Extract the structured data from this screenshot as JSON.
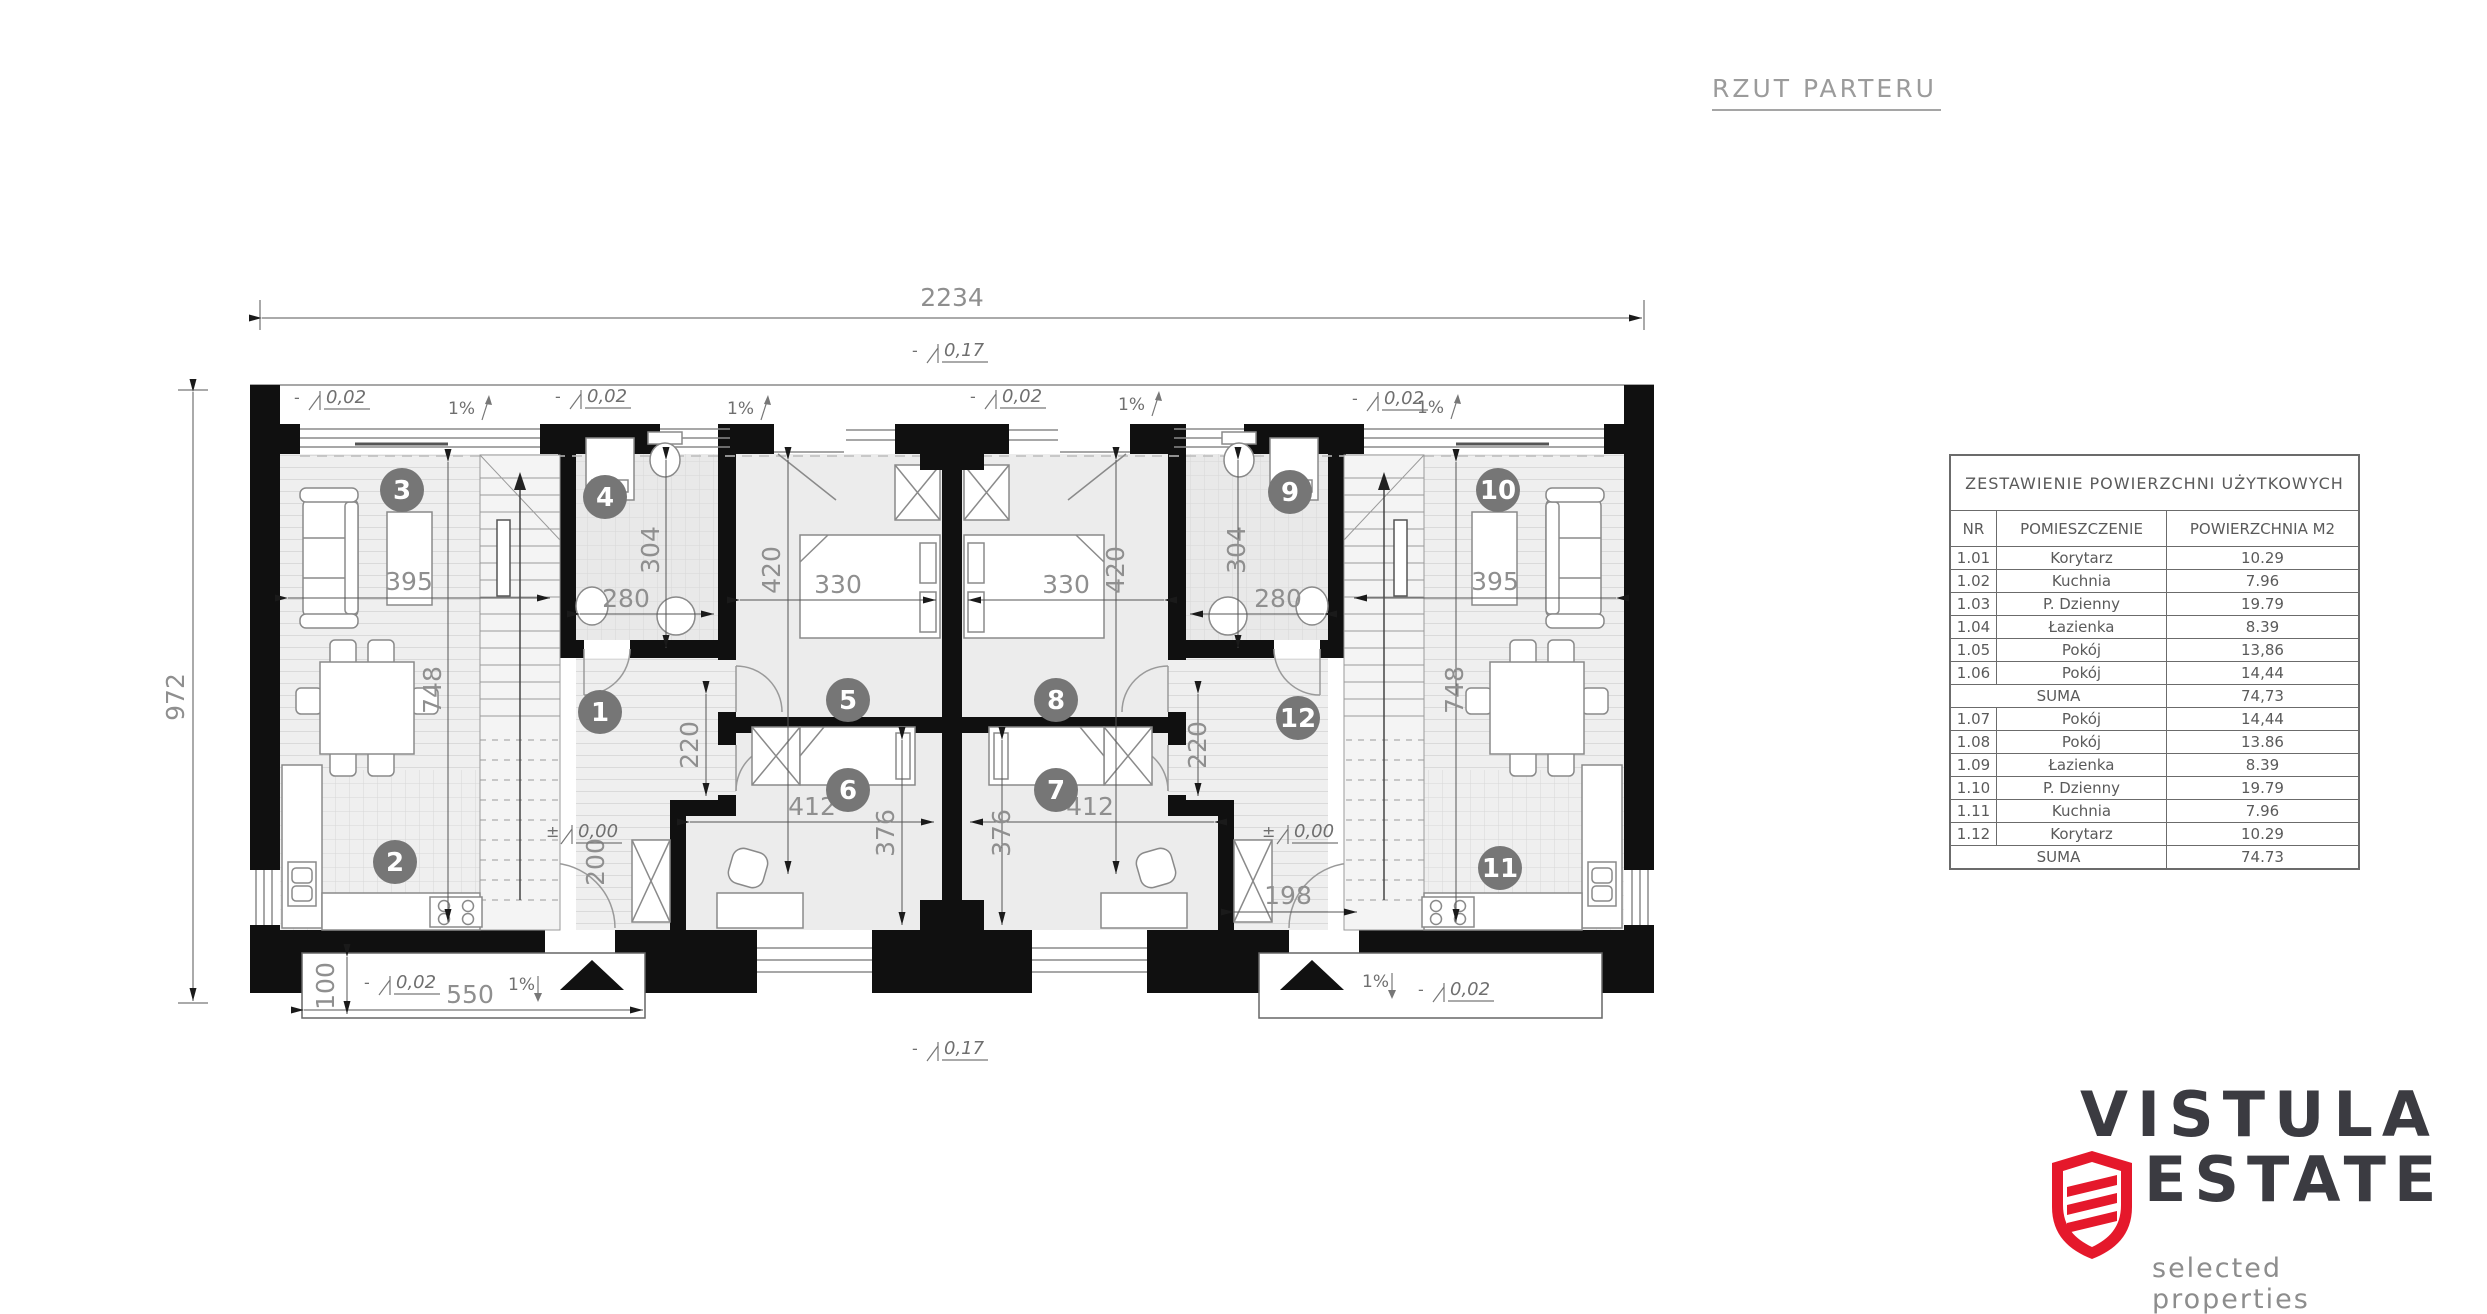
{
  "title": {
    "text": "RZUT PARTERU"
  },
  "area_table": {
    "title": "ZESTAWIENIE POWIERZCHNI UŻYTKOWYCH",
    "columns": [
      "NR",
      "POMIESZCZENIE",
      "POWIERZCHNIA M2"
    ],
    "rows": [
      {
        "nr": "1.01",
        "room": "Korytarz",
        "area": "10.29"
      },
      {
        "nr": "1.02",
        "room": "Kuchnia",
        "area": "7.96"
      },
      {
        "nr": "1.03",
        "room": "P. Dzienny",
        "area": "19.79"
      },
      {
        "nr": "1.04",
        "room": "Łazienka",
        "area": "8.39"
      },
      {
        "nr": "1.05",
        "room": "Pokój",
        "area": "13,86"
      },
      {
        "nr": "1.06",
        "room": "Pokój",
        "area": "14,44"
      },
      {
        "nr": "",
        "room": "SUMA",
        "area": "74,73"
      },
      {
        "nr": "1.07",
        "room": "Pokój",
        "area": "14,44"
      },
      {
        "nr": "1.08",
        "room": "Pokój",
        "area": "13.86"
      },
      {
        "nr": "1.09",
        "room": "Łazienka",
        "area": "8.39"
      },
      {
        "nr": "1.10",
        "room": "P. Dzienny",
        "area": "19.79"
      },
      {
        "nr": "1.11",
        "room": "Kuchnia",
        "area": "7.96"
      },
      {
        "nr": "1.12",
        "room": "Korytarz",
        "area": "10.29"
      },
      {
        "nr": "",
        "room": "SUMA",
        "area": "74.73"
      }
    ]
  },
  "logo": {
    "line1": "VISTULA",
    "line2": "ESTATE",
    "tagline": "selected properties",
    "accent_color": "#e5182b",
    "text_color": "#3b3b41",
    "tagline_color": "#8d8d8d"
  },
  "plan": {
    "room_markers": [
      {
        "n": "1",
        "x": 600,
        "y": 712
      },
      {
        "n": "2",
        "x": 395,
        "y": 862
      },
      {
        "n": "3",
        "x": 402,
        "y": 490
      },
      {
        "n": "4",
        "x": 605,
        "y": 497
      },
      {
        "n": "5",
        "x": 848,
        "y": 700
      },
      {
        "n": "6",
        "x": 848,
        "y": 790
      },
      {
        "n": "7",
        "x": 1056,
        "y": 790
      },
      {
        "n": "8",
        "x": 1056,
        "y": 700
      },
      {
        "n": "9",
        "x": 1290,
        "y": 492
      },
      {
        "n": "10",
        "x": 1498,
        "y": 490
      },
      {
        "n": "11",
        "x": 1500,
        "y": 868
      },
      {
        "n": "12",
        "x": 1298,
        "y": 718
      }
    ],
    "dim_labels": [
      {
        "text": "2234",
        "x": 952,
        "y": 306,
        "rot": 0,
        "size": 27
      },
      {
        "text": "972",
        "x": 184,
        "y": 697,
        "rot": -90,
        "size": 27
      },
      {
        "text": "395",
        "x": 409,
        "y": 590,
        "rot": 0
      },
      {
        "text": "395",
        "x": 1495,
        "y": 590,
        "rot": 0
      },
      {
        "text": "748",
        "x": 441,
        "y": 690,
        "rot": -90
      },
      {
        "text": "748",
        "x": 1463,
        "y": 690,
        "rot": -90
      },
      {
        "text": "304",
        "x": 659,
        "y": 550,
        "rot": -90
      },
      {
        "text": "304",
        "x": 1245,
        "y": 550,
        "rot": -90
      },
      {
        "text": "280",
        "x": 626,
        "y": 607,
        "rot": 0
      },
      {
        "text": "280",
        "x": 1278,
        "y": 607,
        "rot": 0
      },
      {
        "text": "420",
        "x": 780,
        "y": 570,
        "rot": -90
      },
      {
        "text": "420",
        "x": 1124,
        "y": 570,
        "rot": -90
      },
      {
        "text": "330",
        "x": 838,
        "y": 593,
        "rot": 0
      },
      {
        "text": "330",
        "x": 1066,
        "y": 593,
        "rot": 0
      },
      {
        "text": "220",
        "x": 698,
        "y": 745,
        "rot": -90
      },
      {
        "text": "220",
        "x": 1206,
        "y": 745,
        "rot": -90
      },
      {
        "text": "412",
        "x": 812,
        "y": 815,
        "rot": 0
      },
      {
        "text": "412",
        "x": 1090,
        "y": 815,
        "rot": 0
      },
      {
        "text": "376",
        "x": 894,
        "y": 833,
        "rot": -90
      },
      {
        "text": "376",
        "x": 1010,
        "y": 833,
        "rot": -90
      },
      {
        "text": "200",
        "x": 604,
        "y": 862,
        "rot": -90
      },
      {
        "text": "198",
        "x": 1288,
        "y": 904,
        "rot": 0
      },
      {
        "text": "100",
        "x": 334,
        "y": 986,
        "rot": -90
      },
      {
        "text": "550",
        "x": 470,
        "y": 1003,
        "rot": 0
      }
    ],
    "level_marks": [
      {
        "prefix": "-",
        "text": "0,02",
        "x": 322,
        "y": 400
      },
      {
        "prefix": "-",
        "text": "0,02",
        "x": 583,
        "y": 399
      },
      {
        "prefix": "-",
        "text": "0,02",
        "x": 998,
        "y": 399
      },
      {
        "prefix": "-",
        "text": "0,02",
        "x": 1380,
        "y": 401
      },
      {
        "prefix": "-",
        "text": "0,02",
        "x": 392,
        "y": 985
      },
      {
        "prefix": "-",
        "text": "0,02",
        "x": 1446,
        "y": 992
      },
      {
        "prefix": "±",
        "text": "0,00",
        "x": 574,
        "y": 834
      },
      {
        "prefix": "±",
        "text": "0,00",
        "x": 1290,
        "y": 834
      },
      {
        "prefix": "-",
        "text": "0,17",
        "x": 940,
        "y": 353
      },
      {
        "prefix": "-",
        "text": "0,17",
        "x": 940,
        "y": 1051
      }
    ],
    "slope_labels": [
      {
        "text": "1%",
        "x": 448,
        "y": 414,
        "dir": "up"
      },
      {
        "text": "1%",
        "x": 727,
        "y": 414,
        "dir": "up"
      },
      {
        "text": "1%",
        "x": 1118,
        "y": 410,
        "dir": "up"
      },
      {
        "text": "1%",
        "x": 1417,
        "y": 413,
        "dir": "up"
      },
      {
        "text": "1%",
        "x": 508,
        "y": 990,
        "dir": "down"
      },
      {
        "text": "1%",
        "x": 1362,
        "y": 987,
        "dir": "down"
      }
    ]
  }
}
